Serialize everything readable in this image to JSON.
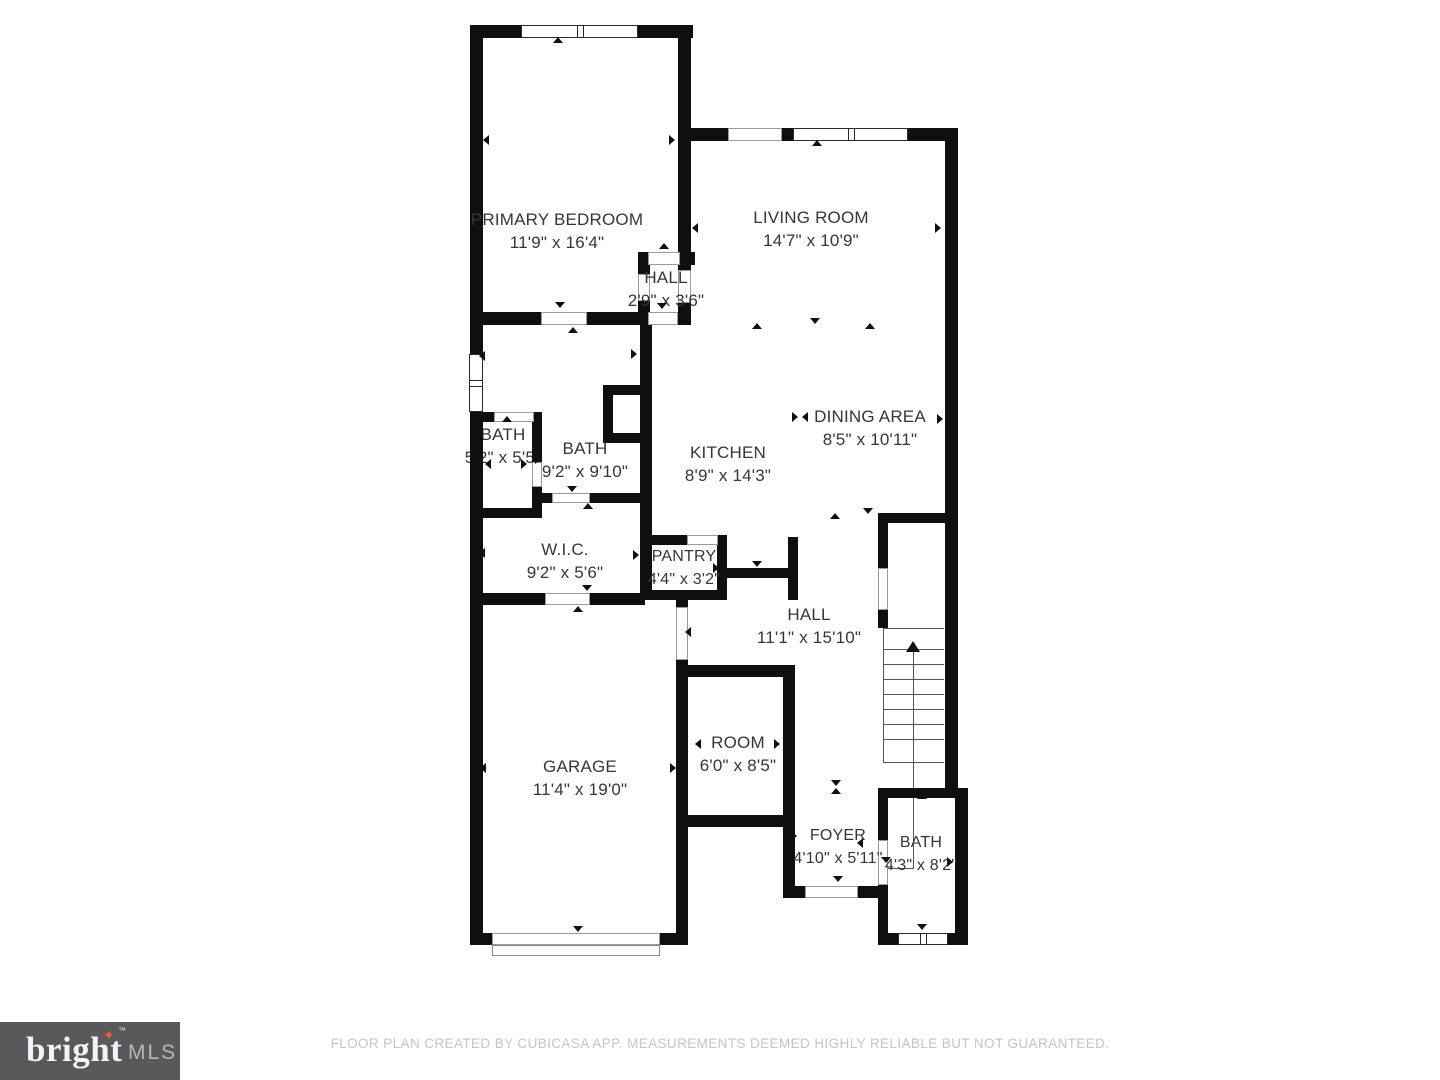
{
  "plan": {
    "rooms": [
      {
        "id": "primary-bedroom",
        "name": "PRIMARY BEDROOM",
        "dims": "11'9\" x 16'4\""
      },
      {
        "id": "living-room",
        "name": "LIVING ROOM",
        "dims": "14'7\" x 10'9\""
      },
      {
        "id": "hall-upper",
        "name": "HALL",
        "dims": "2'9\" x 3'6\""
      },
      {
        "id": "bath-left",
        "name": "BATH",
        "dims": "5'2\" x 5'5\""
      },
      {
        "id": "bath-mid",
        "name": "BATH",
        "dims": "9'2\" x 9'10\""
      },
      {
        "id": "kitchen",
        "name": "KITCHEN",
        "dims": "8'9\" x 14'3\""
      },
      {
        "id": "dining-area",
        "name": "DINING AREA",
        "dims": "8'5\" x 10'11\""
      },
      {
        "id": "wic",
        "name": "W.I.C.",
        "dims": "9'2\" x 5'6\""
      },
      {
        "id": "pantry",
        "name": "PANTRY",
        "dims": "4'4\" x 3'2\""
      },
      {
        "id": "hall-lower",
        "name": "HALL",
        "dims": "11'1\" x 15'10\""
      },
      {
        "id": "garage",
        "name": "GARAGE",
        "dims": "11'4\" x 19'0\""
      },
      {
        "id": "room",
        "name": "ROOM",
        "dims": "6'0\" x 8'5\""
      },
      {
        "id": "foyer",
        "name": "FOYER",
        "dims": "4'10\" x 5'11\""
      },
      {
        "id": "bath-lower",
        "name": "BATH",
        "dims": "4'3\" x 8'2\""
      }
    ]
  },
  "footer": {
    "logo": {
      "brand": "bright",
      "star": "✦",
      "tm": "™",
      "suffix": "MLS"
    },
    "disclaimer": "FLOOR PLAN CREATED BY CUBICASA APP. MEASUREMENTS DEEMED HIGHLY RELIABLE BUT NOT GUARANTEED."
  },
  "colors": {
    "wall": "#0f0f0f",
    "label": "#363636",
    "logo_bg": "#59595b",
    "logo_star": "#e8622d",
    "disclaimer_text": "#c5c5c5"
  }
}
